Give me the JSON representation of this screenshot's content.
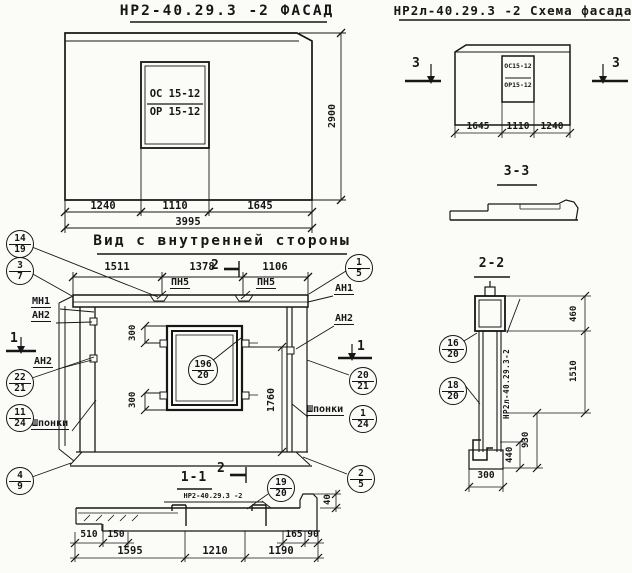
{
  "facade": {
    "title": "НР2-40.29.3 -2 ФАСАД",
    "win_top": "ОС 15-12",
    "win_bot": "ОР 15-12",
    "dims": [
      "1240",
      "1110",
      "1645"
    ],
    "total": "3995",
    "height": "2900"
  },
  "schema": {
    "title": "НР2л-40.29.3 -2 Схема фасада",
    "win_top": "ОС15-12",
    "win_bot": "ОР15-12",
    "dims": [
      "1645",
      "1110",
      "1240"
    ],
    "marker": "3",
    "section_title": "3-3"
  },
  "inner": {
    "title": "Вид с внутренней стороны",
    "top_dims": [
      "1511",
      "1378",
      "1106"
    ],
    "marker1": "1",
    "marker2": "2",
    "pn5": "ПН5",
    "mn1": "МН1",
    "an1": "АН1",
    "an2": "АН2",
    "shponki": "Шпонки",
    "dim300": "300",
    "dim1760": "1760",
    "win_callout_top": "196",
    "win_callout_bot": "20"
  },
  "callouts": {
    "left": [
      [
        "14",
        "19"
      ],
      [
        "3",
        "7"
      ],
      [
        "22",
        "21"
      ],
      [
        "11",
        "24"
      ],
      [
        "4",
        "9"
      ]
    ],
    "right": [
      [
        "1",
        "5"
      ],
      [
        "20",
        "21"
      ],
      [
        "1",
        "24"
      ],
      [
        "2",
        "5"
      ]
    ],
    "s22": [
      [
        "16",
        "20"
      ],
      [
        "18",
        "20"
      ]
    ],
    "s11": [
      "19",
      "20"
    ]
  },
  "s22": {
    "title": "2-2",
    "mark": "НР2л-40.29.3-2",
    "d460": "460",
    "d1510": "1510",
    "d930": "930",
    "d440": "440",
    "d300": "300"
  },
  "s11": {
    "title": "1-1",
    "mark": "НР2-40.29.3 -2",
    "marker2": "2",
    "row1": [
      "510",
      "150",
      "165",
      "90"
    ],
    "row2": [
      "1595",
      "1210",
      "1190"
    ],
    "d40": "40"
  }
}
